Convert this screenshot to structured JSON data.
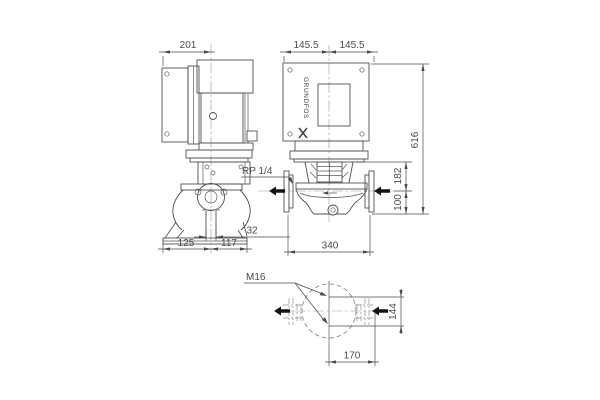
{
  "brand": {
    "name": "GRUNDFOS"
  },
  "dims": {
    "motor_width": "201",
    "half_width_left": "145.5",
    "half_width_right": "145.5",
    "total_height": "616",
    "head_height": "182",
    "port_to_base": "100",
    "gauge_connection": "RP 1/4",
    "drain_width": "32",
    "base_left": "125",
    "base_right": "117",
    "port_to_port": "340",
    "bolt_thread": "M16",
    "bolt_span_vertical": "144",
    "bolt_span_horizontal": "170"
  }
}
